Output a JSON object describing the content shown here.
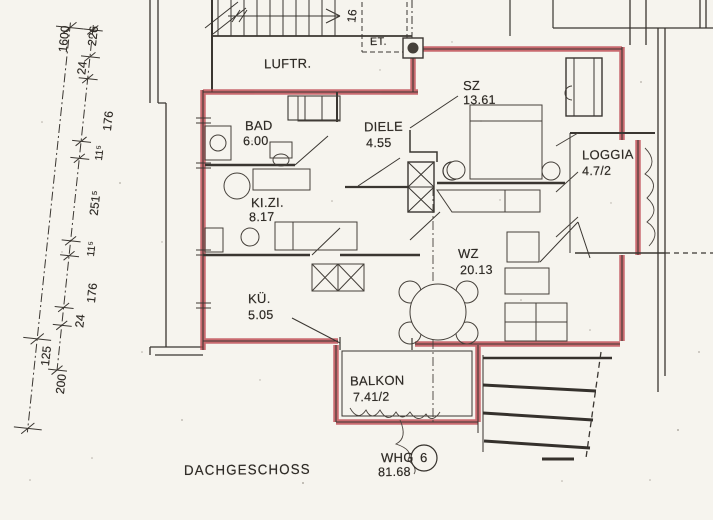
{
  "drawing": {
    "floor_label": "DACHGESCHOSS",
    "unit": {
      "prefix": "WHG",
      "number": "6",
      "total_area": "81.68"
    },
    "stair_arrow_count": "16"
  },
  "rooms": {
    "luftraum": {
      "name": "LUFTR."
    },
    "entree": {
      "name": "ET."
    },
    "schlafzimmer": {
      "name": "SZ",
      "area": "13.61"
    },
    "bad": {
      "name": "BAD",
      "area": "6.00"
    },
    "diele": {
      "name": "DIELE",
      "area": "4.55"
    },
    "kinderzimmer": {
      "name": "KI.ZI.",
      "area": "8.17"
    },
    "kueche": {
      "name": "KÜ.",
      "area": "5.05"
    },
    "wohnzimmer": {
      "name": "WZ",
      "area": "20.13"
    },
    "loggia": {
      "name": "LOGGIA",
      "area": "4.7/2"
    },
    "balkon": {
      "name": "BALKON",
      "area": "7.41/2"
    }
  },
  "dimensions": {
    "overall": "1600",
    "segments": [
      "226",
      "24",
      "176",
      "11⁵",
      "251⁵",
      "11⁵",
      "176",
      "24",
      "125"
    ],
    "below": "200"
  },
  "colors": {
    "highlight_wall": "#bf4850",
    "ink": "#33302b",
    "paper": "#f6f4ee"
  }
}
